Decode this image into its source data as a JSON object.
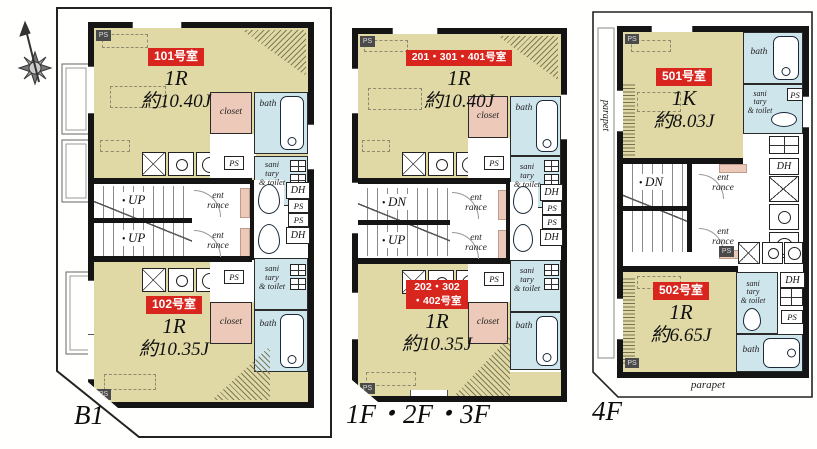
{
  "colors": {
    "floor_tatami": "#e0d9a6",
    "wet_area_blue": "#cfe5ec",
    "closet_pink": "#ecc9b8",
    "unit_badge_red": "#d8251d",
    "wall_black": "#141414"
  },
  "labels": {
    "bath": "bath",
    "closet": "closet",
    "sanitary": "sani\ntary\n& toilet",
    "entrance": "ent\nrance",
    "dh": "DH",
    "ps": "PS",
    "parapet": "parapet"
  },
  "plans": [
    {
      "name": "B1",
      "stair_labels": [
        "UP",
        "UP"
      ],
      "units": [
        {
          "badge": "101号室",
          "type": "1R",
          "area": "約10.40J"
        },
        {
          "badge": "102号室",
          "type": "1R",
          "area": "約10.35J"
        }
      ]
    },
    {
      "name": "1F・2F・3F",
      "stair_labels": [
        "DN",
        "UP"
      ],
      "units": [
        {
          "badge": "201・301・401号室",
          "type": "1R",
          "area": "約10.40J"
        },
        {
          "badge": "202・302\n・402号室",
          "type": "1R",
          "area": "約10.35J"
        }
      ]
    },
    {
      "name": "4F",
      "stair_labels": [
        "DN"
      ],
      "units": [
        {
          "badge": "501号室",
          "type": "1K",
          "area": "約8.03J"
        },
        {
          "badge": "502号室",
          "type": "1R",
          "area": "約6.65J"
        }
      ]
    }
  ]
}
